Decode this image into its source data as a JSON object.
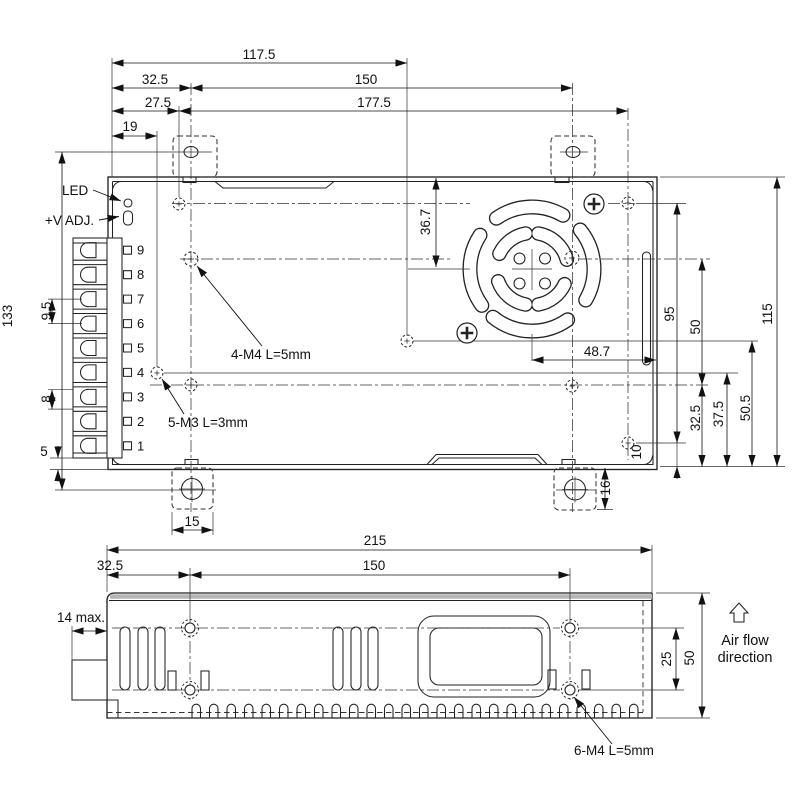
{
  "top_view": {
    "labels": {
      "led": "LED",
      "v_adj": "+V ADJ.",
      "note_m4": "4-M4 L=5mm",
      "note_m3": "5-M3 L=3mm"
    },
    "terminal_numbers": [
      "9",
      "8",
      "7",
      "6",
      "5",
      "4",
      "3",
      "2",
      "1"
    ],
    "dims": {
      "edge_to_center_hole": "117.5",
      "edge_to_tab": "32.5",
      "tab_spacing": "150",
      "edge_to_m3a": "27.5",
      "m3_span": "177.5",
      "edge_to_m3b": "19",
      "tab_hole_span": "133",
      "terminal_pitch": "9.5",
      "terminal_opening": "8",
      "block_to_edge": "5",
      "fan_center_from_top": "36.7",
      "fan_center_from_right": "48.7",
      "side_holes_span": "95",
      "hole_rows_span": "50",
      "case_depth": "115",
      "m3_row_from_bottom": "32.5",
      "m3_row2_from_bottom": "37.5",
      "center_hole_from_bottom": "50.5",
      "side_hole_from_bottom": "10",
      "tab_width": "15",
      "tab_length": "16"
    }
  },
  "side_view": {
    "labels": {
      "note_m4": "6-M4 L=5mm",
      "airflow_1": "Air flow",
      "airflow_2": "direction",
      "terminal_depth": "14 max."
    },
    "dims": {
      "length": "215",
      "hole_offset": "32.5",
      "hole_spacing": "150",
      "hole_rows": "25",
      "height": "50"
    }
  }
}
